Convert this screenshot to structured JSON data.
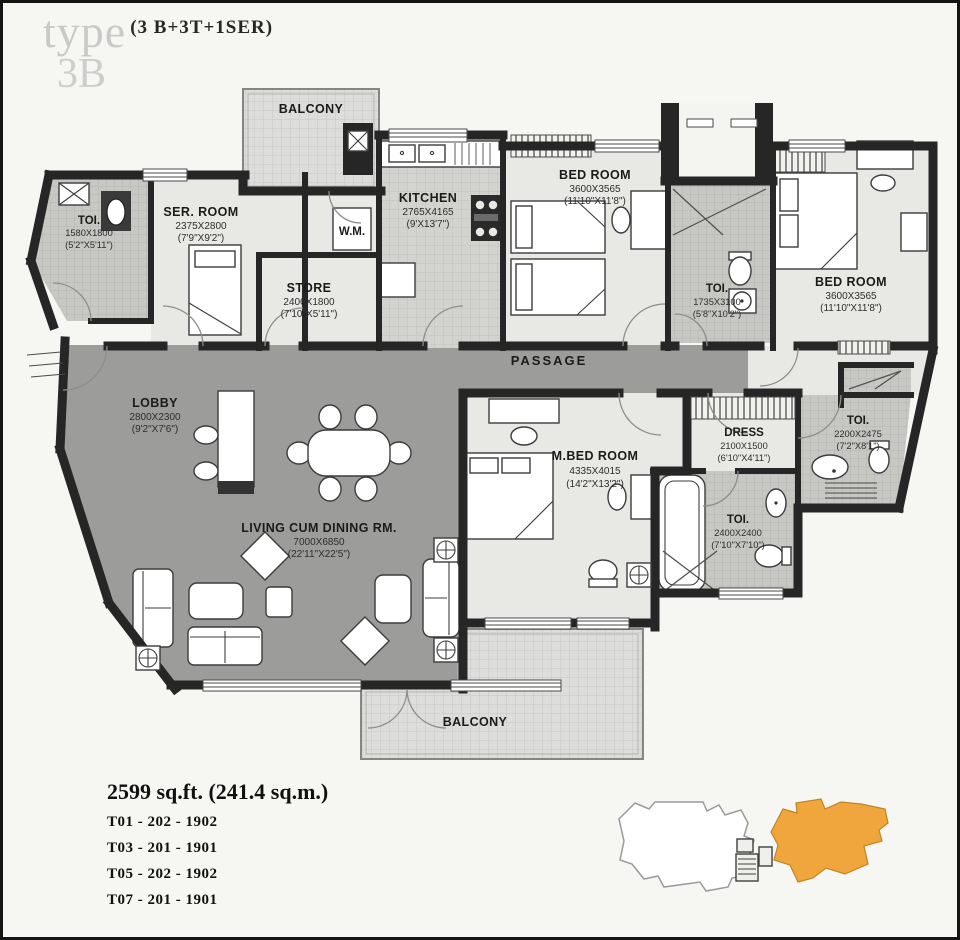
{
  "title": {
    "type_label": "type",
    "type_code": "(3 B+3T+1SER)",
    "type_name": "3B"
  },
  "rooms": {
    "balcony_top": {
      "name": "BALCONY"
    },
    "toi_entry": {
      "name": "TOI.",
      "mm": "1580X1800",
      "ft": "(5'2\"X5'11\")"
    },
    "ser_room": {
      "name": "SER. ROOM",
      "mm": "2375X2800",
      "ft": "(7'9\"X9'2\")"
    },
    "store": {
      "name": "STORE",
      "mm": "2400X1800",
      "ft": "(7'10\"X5'11\")"
    },
    "kitchen": {
      "name": "KITCHEN",
      "mm": "2765X4165",
      "ft": "(9'X13'7\")"
    },
    "wm": {
      "name": "W.M."
    },
    "bed_room_2": {
      "name": "BED ROOM",
      "mm": "3600X3565",
      "ft": "(11'10\"X11'8\")"
    },
    "toi_2": {
      "name": "TOI.",
      "mm": "1735X3100",
      "ft": "(5'8\"X10'2\")"
    },
    "bed_room_3": {
      "name": "BED ROOM",
      "mm": "3600X3565",
      "ft": "(11'10\"X11'8\")"
    },
    "passage": {
      "name": "PASSAGE"
    },
    "lobby": {
      "name": "LOBBY",
      "mm": "2800X2300",
      "ft": "(9'2\"X7'6\")"
    },
    "living": {
      "name": "LIVING CUM DINING RM.",
      "mm": "7000X6850",
      "ft": "(22'11\"X22'5\")"
    },
    "m_bed": {
      "name": "M.BED ROOM",
      "mm": "4335X4015",
      "ft": "(14'2\"X13'2\")"
    },
    "dress": {
      "name": "DRESS",
      "mm": "2100X1500",
      "ft": "(6'10\"X4'11\")"
    },
    "toi_master": {
      "name": "TOI.",
      "mm": "2400X2400",
      "ft": "(7'10\"X7'10\")"
    },
    "toi_right": {
      "name": "TOI.",
      "mm": "2200X2475",
      "ft": "(7'2\"X8'1\")"
    },
    "balcony_bottom": {
      "name": "BALCONY"
    }
  },
  "footer": {
    "area": "2599 sq.ft. (241.4 sq.m.)",
    "units": [
      "T01 - 202 - 1902",
      "T03 - 201 - 1901",
      "T05 - 202 - 1902",
      "T07 - 201 - 1901"
    ]
  },
  "colors": {
    "wall": "#262626",
    "room_light": "#e8e8e5",
    "zone_dark": "#9c9c9b",
    "highlight_orange": "#F0A63C"
  }
}
